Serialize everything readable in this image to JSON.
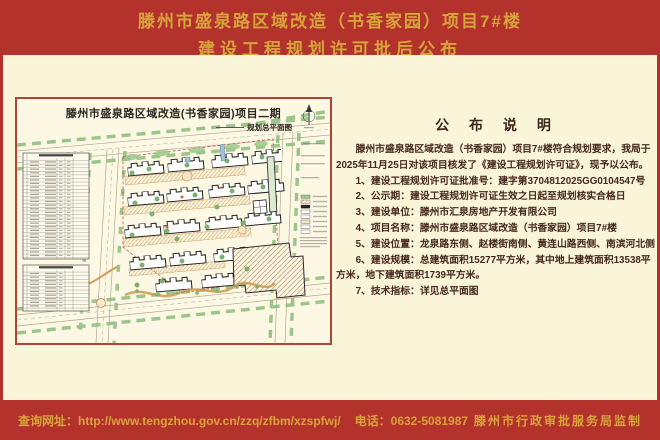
{
  "header": {
    "title_line1": "滕州市盛泉路区域改造（书香家园）项目7#楼",
    "title_line2": "建设工程规划许可批后公布"
  },
  "plan": {
    "title": "滕州市盛泉路区域改造(书香家园)项目二期",
    "subtitle": "规划总平面图"
  },
  "notice": {
    "title": "公 布 说 明",
    "intro": "滕州市盛泉路区域改造（书香家园）项目7#楼符合规划要求，我局于2025年11月25日对该项目核发了《建设工程规划许可证》，现予以公布。",
    "items": [
      "1、建设工程规划许可证批准号：建字第3704812025GG0104547号",
      "2、公示期：建设工程规划许可证生效之日起至规划核实合格日",
      "3、建设单位：滕州市汇泉房地产开发有限公司",
      "4、项目名称：滕州市盛泉路区域改造（书香家园）项目7#楼",
      "5、建设位置：龙泉路东侧、赵楼街南侧、黄连山路西侧、南滨河北侧",
      "6、建设规模：总建筑面积15277平方米，其中地上建筑面积13538平方米，地下建筑面积1739平方米。",
      "7、技术指标：详见总平面图"
    ]
  },
  "footer": {
    "query": "查询网址：http://www.tengzhou.gov.cn/zzq/zfbm/xzspfwj/",
    "phone": "电话：0632-5081987",
    "producer": "滕州市行政审批服务局监制"
  },
  "colors": {
    "band_red": "#b4322c",
    "gold": "#d9a33c",
    "cream": "#faf4d8",
    "plan_background": "#fcf8e4",
    "plan_border_red": "#b14238",
    "notice_text": "#45291e"
  }
}
